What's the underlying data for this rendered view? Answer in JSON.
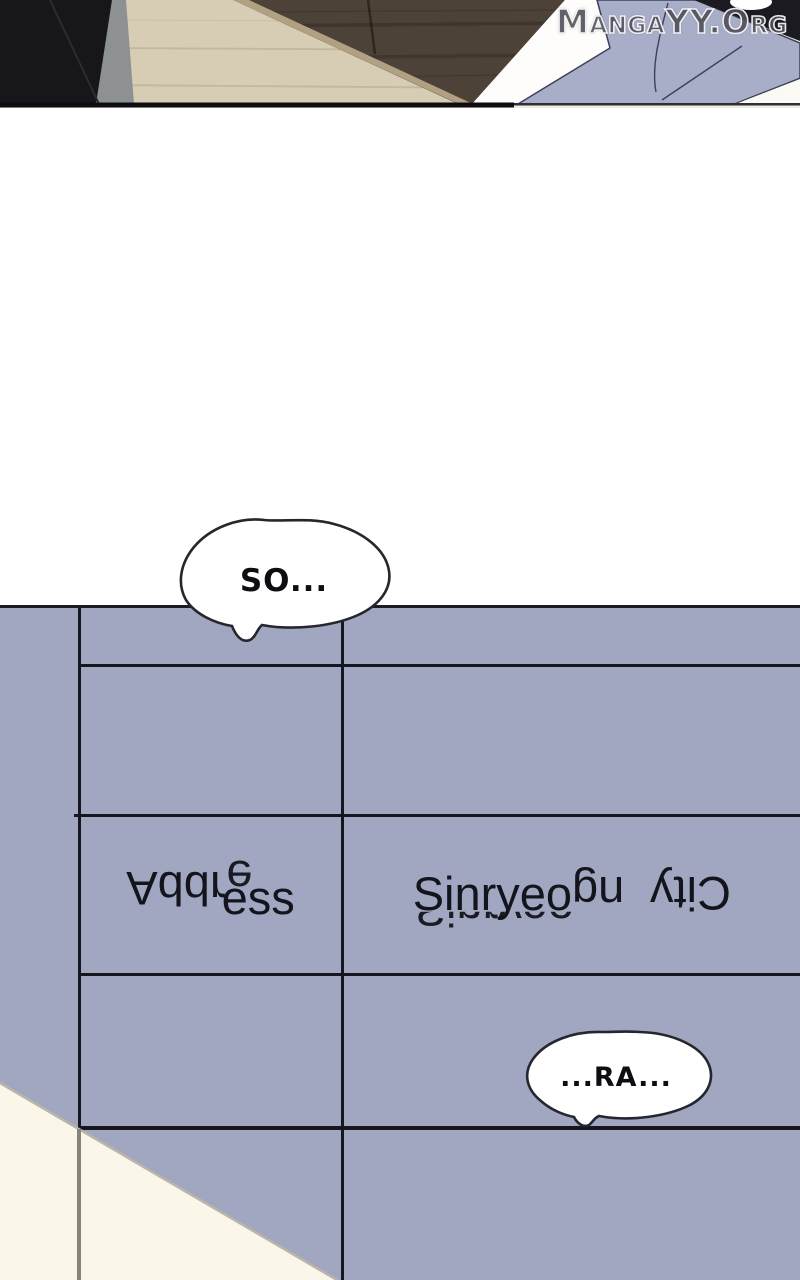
{
  "watermark": {
    "text": "MangaYY.Org"
  },
  "bubbles": {
    "so": {
      "text": "SO..."
    },
    "ra": {
      "text": "...RA..."
    }
  },
  "form_table": {
    "address_label": {
      "full_text": "Address",
      "seg_flipped": "Addr",
      "seg_ghost": "e",
      "seg_normal": "ess"
    },
    "address_value": {
      "full_text": "Sinryeong City",
      "seg_normal": "Sinryeo",
      "seg_ghost": "Sinryeo",
      "seg_rotated_a": "ng",
      "seg_rotated_b": "City"
    }
  },
  "colors": {
    "panel_purple": "#a1a7c1",
    "grid_line_dark": "#16161f",
    "corner_paper_cream": "#faf6e9",
    "floor_beige": "#d7ccb4",
    "table_brown": "#4c4238",
    "paper_periwinkle": "#a9aec8",
    "figure_black": "#17171b"
  }
}
